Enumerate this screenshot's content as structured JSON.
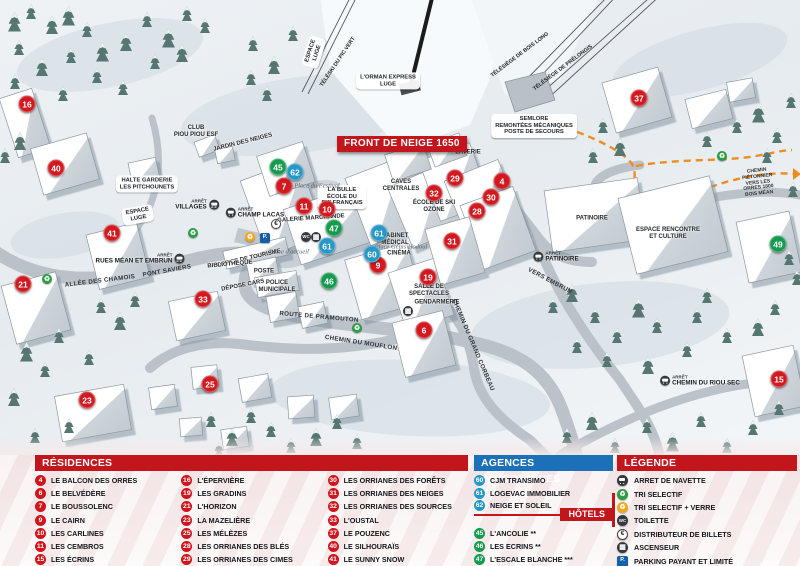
{
  "colors": {
    "red": "#c3161c",
    "blue": "#1c70b7",
    "teal": "#2598c7",
    "green": "#169a4e",
    "marker_red": "#d31920",
    "path_orange": "#f08c1e"
  },
  "map": {
    "banner": "FRONT DE NEIGE 1650",
    "markers": [
      {
        "n": "16",
        "x": 27,
        "y": 104,
        "c": "red"
      },
      {
        "n": "40",
        "x": 56,
        "y": 168,
        "c": "red"
      },
      {
        "n": "41",
        "x": 112,
        "y": 233,
        "c": "red"
      },
      {
        "n": "21",
        "x": 23,
        "y": 284,
        "c": "red"
      },
      {
        "n": "33",
        "x": 203,
        "y": 299,
        "c": "red"
      },
      {
        "n": "23",
        "x": 87,
        "y": 400,
        "c": "red"
      },
      {
        "n": "25",
        "x": 210,
        "y": 384,
        "c": "red"
      },
      {
        "n": "7",
        "x": 284,
        "y": 186,
        "c": "red"
      },
      {
        "n": "11",
        "x": 304,
        "y": 206,
        "c": "red"
      },
      {
        "n": "10",
        "x": 327,
        "y": 209,
        "c": "red"
      },
      {
        "n": "9",
        "x": 378,
        "y": 265,
        "c": "red"
      },
      {
        "n": "19",
        "x": 428,
        "y": 277,
        "c": "red"
      },
      {
        "n": "6",
        "x": 424,
        "y": 330,
        "c": "red"
      },
      {
        "n": "29",
        "x": 455,
        "y": 178,
        "c": "red"
      },
      {
        "n": "4",
        "x": 502,
        "y": 181,
        "c": "red"
      },
      {
        "n": "30",
        "x": 491,
        "y": 197,
        "c": "red"
      },
      {
        "n": "28",
        "x": 477,
        "y": 211,
        "c": "red"
      },
      {
        "n": "32",
        "x": 434,
        "y": 193,
        "c": "red"
      },
      {
        "n": "31",
        "x": 452,
        "y": 241,
        "c": "red"
      },
      {
        "n": "37",
        "x": 639,
        "y": 98,
        "c": "red"
      },
      {
        "n": "15",
        "x": 779,
        "y": 379,
        "c": "red"
      },
      {
        "n": "45",
        "x": 278,
        "y": 167,
        "c": "green"
      },
      {
        "n": "47",
        "x": 334,
        "y": 228,
        "c": "green"
      },
      {
        "n": "46",
        "x": 329,
        "y": 281,
        "c": "green"
      },
      {
        "n": "49",
        "x": 778,
        "y": 244,
        "c": "green"
      },
      {
        "n": "62",
        "x": 295,
        "y": 172,
        "c": "teal"
      },
      {
        "n": "61",
        "x": 379,
        "y": 233,
        "c": "teal"
      },
      {
        "n": "61",
        "x": 327,
        "y": 246,
        "c": "teal"
      },
      {
        "n": "60",
        "x": 372,
        "y": 254,
        "c": "teal"
      }
    ],
    "labels": [
      {
        "t": "CLUB\nPIOU PIOU ESF",
        "x": 196,
        "y": 132,
        "c": "plain"
      },
      {
        "t": "JARDIN DES NEIGES",
        "x": 243,
        "y": 143,
        "c": "plain",
        "rot": -14
      },
      {
        "t": "HALTE GARDERIE\nLES PITCHOUNETS",
        "x": 147,
        "y": 184,
        "c": "pill"
      },
      {
        "t": "ESPACE\nLUGE",
        "x": 138,
        "y": 215,
        "c": "pill",
        "rot": -10
      },
      {
        "t": "ESPACE\nLUGE",
        "x": 314,
        "y": 52,
        "c": "pill",
        "rot": -72
      },
      {
        "t": "L'ORMAN EXPRESS\nLUGE",
        "x": 388,
        "y": 81,
        "c": "pill"
      },
      {
        "t": "TÉLÉSKI DU PIC VERT",
        "x": 338,
        "y": 62,
        "c": "lift",
        "rot": -56
      },
      {
        "t": "TÉLÉSIÈGE DE BOIS LONG",
        "x": 520,
        "y": 55,
        "c": "lift",
        "rot": -37
      },
      {
        "t": "TÉLÉSIÈGE DE PRÉLONGIS",
        "x": 563,
        "y": 68,
        "c": "lift",
        "rot": -37
      },
      {
        "t": "SEMLORE\nREMONTÉES MÉCANIQUES\nPOSTE DE SECOURS",
        "x": 534,
        "y": 126,
        "c": "pill"
      },
      {
        "t": "LA BULLE\nÉCOLE DU\nSKI FRANÇAIS",
        "x": 342,
        "y": 197,
        "c": "pill"
      },
      {
        "t": "CAVES\nCENTRALES",
        "x": 401,
        "y": 186,
        "c": "plain"
      },
      {
        "t": "LAVERIE",
        "x": 468,
        "y": 153,
        "c": "plain"
      },
      {
        "t": "GALERIE MARCHANDE",
        "x": 311,
        "y": 219,
        "c": "plain",
        "rot": -4
      },
      {
        "t": "ÉCOLE DE SKI\nOZONE",
        "x": 434,
        "y": 207,
        "c": "plain"
      },
      {
        "t": "CABINET\nMÉDICAL",
        "x": 395,
        "y": 240,
        "c": "plain"
      },
      {
        "t": "CINÉMA",
        "x": 399,
        "y": 254,
        "c": "plain"
      },
      {
        "t": "PATINOIRE",
        "x": 592,
        "y": 219,
        "c": "plain"
      },
      {
        "t": "ESPACE RENCONTRE\nET CULTURE",
        "x": 668,
        "y": 234,
        "c": "plain"
      },
      {
        "t": "SALLE DE\nSPECTACLES",
        "x": 429,
        "y": 291,
        "c": "plain"
      },
      {
        "t": "GENDARMERIE",
        "x": 437,
        "y": 303,
        "c": "plain"
      },
      {
        "t": "OFFICE DE TOURISME",
        "x": 249,
        "y": 259,
        "c": "plain",
        "rot": -13
      },
      {
        "t": "BIBLIOTHÈQUE",
        "x": 230,
        "y": 265,
        "c": "plain",
        "rot": -5
      },
      {
        "t": "POSTE",
        "x": 264,
        "y": 272,
        "c": "plain"
      },
      {
        "t": "POLICE\nMUNICIPALE",
        "x": 277,
        "y": 287,
        "c": "plain"
      },
      {
        "t": "DÉPOSE CARS",
        "x": 243,
        "y": 286,
        "c": "plain",
        "rot": -11
      },
      {
        "t": "Place d'accueil",
        "x": 289,
        "y": 252,
        "c": "script"
      },
      {
        "t": "Place du Festival",
        "x": 317,
        "y": 186,
        "c": "script"
      },
      {
        "t": "Place Génis Hodoul",
        "x": 401,
        "y": 247,
        "c": "script"
      },
      {
        "t": "ALLÉE DES CHAMOIS",
        "x": 100,
        "y": 281,
        "c": "road",
        "rot": -7
      },
      {
        "t": "PONT SAVIERS",
        "x": 167,
        "y": 271,
        "c": "road",
        "rot": -10
      },
      {
        "t": "ROUTE DE PRAMOUTON",
        "x": 319,
        "y": 317,
        "c": "road",
        "rot": 5
      },
      {
        "t": "CHEMIN DU MOUFLON",
        "x": 361,
        "y": 343,
        "c": "road",
        "rot": 9
      },
      {
        "t": "CHEMIN DU GRAND CORBEAU",
        "x": 473,
        "y": 345,
        "c": "road",
        "rot": 67
      },
      {
        "t": "VERS EMBRUN",
        "x": 550,
        "y": 281,
        "c": "road",
        "rot": 28
      },
      {
        "t": "CHEMIN PIÉTONNIER\nVERS LES ORRES 1800\nBOIS MÉAN",
        "x": 758,
        "y": 183,
        "c": "tiny",
        "rot": -6
      }
    ],
    "stops": [
      {
        "arret": "ARRÊT",
        "t": "VILLAGES",
        "x": 197,
        "y": 205,
        "c": "icon-right"
      },
      {
        "arret": "ARRÊT",
        "t": "CHAMP LACAS",
        "x": 255,
        "y": 213
      },
      {
        "arret": "ARRÊT",
        "t": "RUES MÉAN ET EMBRUN",
        "x": 140,
        "y": 259,
        "c": "icon-right"
      },
      {
        "arret": "ARRÊT",
        "t": "PATINOIRE",
        "x": 556,
        "y": 257
      },
      {
        "arret": "ARRÊT",
        "t": "CHEMIN DU RIOU SEC",
        "x": 700,
        "y": 381
      }
    ],
    "icons": [
      {
        "k": "recycle-green",
        "x": 193,
        "y": 233
      },
      {
        "k": "recycle-green",
        "x": 47,
        "y": 279
      },
      {
        "k": "recycle-green",
        "x": 357,
        "y": 328
      },
      {
        "k": "recycle-green",
        "x": 722,
        "y": 156
      },
      {
        "k": "recycle-yellow",
        "x": 250,
        "y": 237
      },
      {
        "k": "parking",
        "x": 265,
        "y": 238
      },
      {
        "k": "euro",
        "x": 276,
        "y": 224
      },
      {
        "k": "wc",
        "x": 306,
        "y": 237
      },
      {
        "k": "elev",
        "x": 316,
        "y": 237
      },
      {
        "k": "elev",
        "x": 408,
        "y": 311
      }
    ]
  },
  "panel": {
    "residences": {
      "title": "RÉSIDENCES",
      "items": [
        {
          "n": "4",
          "label": "LE BALCON DES ORRES"
        },
        {
          "n": "6",
          "label": "LE BELVÉDÈRE"
        },
        {
          "n": "7",
          "label": "LE BOUSSOLENC"
        },
        {
          "n": "9",
          "label": "LE CAIRN"
        },
        {
          "n": "10",
          "label": "LES CARLINES"
        },
        {
          "n": "11",
          "label": "LES CEMBROS"
        },
        {
          "n": "15",
          "label": "LES ÉCRINS"
        },
        {
          "n": "16",
          "label": "L'ÉPERVIÈRE"
        },
        {
          "n": "19",
          "label": "LES GRADINS"
        },
        {
          "n": "21",
          "label": "L'HORIZON"
        },
        {
          "n": "23",
          "label": "LA MAZELIÈRE"
        },
        {
          "n": "25",
          "label": "LES MÉLÈZES"
        },
        {
          "n": "28",
          "label": "LES ORRIANES DES BLÉS"
        },
        {
          "n": "29",
          "label": "LES ORRIANES DES CIMES"
        },
        {
          "n": "30",
          "label": "LES ORRIANES DES FORÊTS"
        },
        {
          "n": "31",
          "label": "LES ORRIANES DES NEIGES"
        },
        {
          "n": "32",
          "label": "LES ORRIANES DES SOURCES"
        },
        {
          "n": "33",
          "label": "L'OUSTAL"
        },
        {
          "n": "37",
          "label": "LE POUZENC"
        },
        {
          "n": "40",
          "label": "LE SILHOURAÏS"
        },
        {
          "n": "41",
          "label": "LE SUNNY SNOW"
        }
      ]
    },
    "agences": {
      "title": "AGENCES IMMOBILIÈRES",
      "items": [
        {
          "n": "60",
          "label": "CJM TRANSIMO"
        },
        {
          "n": "61",
          "label": "LOGEVAC IMMOBILIER"
        },
        {
          "n": "62",
          "label": "NEIGE ET SOLEIL"
        }
      ]
    },
    "hotels": {
      "title": "HÔTELS",
      "items": [
        {
          "n": "45",
          "label": "L'ANCOLIE **"
        },
        {
          "n": "46",
          "label": "LES ECRINS **"
        },
        {
          "n": "47",
          "label": "L'ESCALE BLANCHE ***"
        },
        {
          "n": "49",
          "label": "LES TRAPPEURS **"
        }
      ]
    },
    "legende": {
      "title": "LÉGENDE",
      "items": [
        {
          "icon": "bus",
          "label": "ARRET DE NAVETTE"
        },
        {
          "icon": "recycle-green",
          "label": "TRI SELECTIF"
        },
        {
          "icon": "recycle-yellow",
          "label": "TRI SELECTIF + VERRE"
        },
        {
          "icon": "wc",
          "label": "TOILETTE"
        },
        {
          "icon": "euro",
          "label": "DISTRIBUTEUR DE BILLETS"
        },
        {
          "icon": "elev",
          "label": "ASCENSEUR"
        },
        {
          "icon": "parking",
          "label": "PARKING PAYANT ET LIMITÉ"
        }
      ]
    }
  }
}
